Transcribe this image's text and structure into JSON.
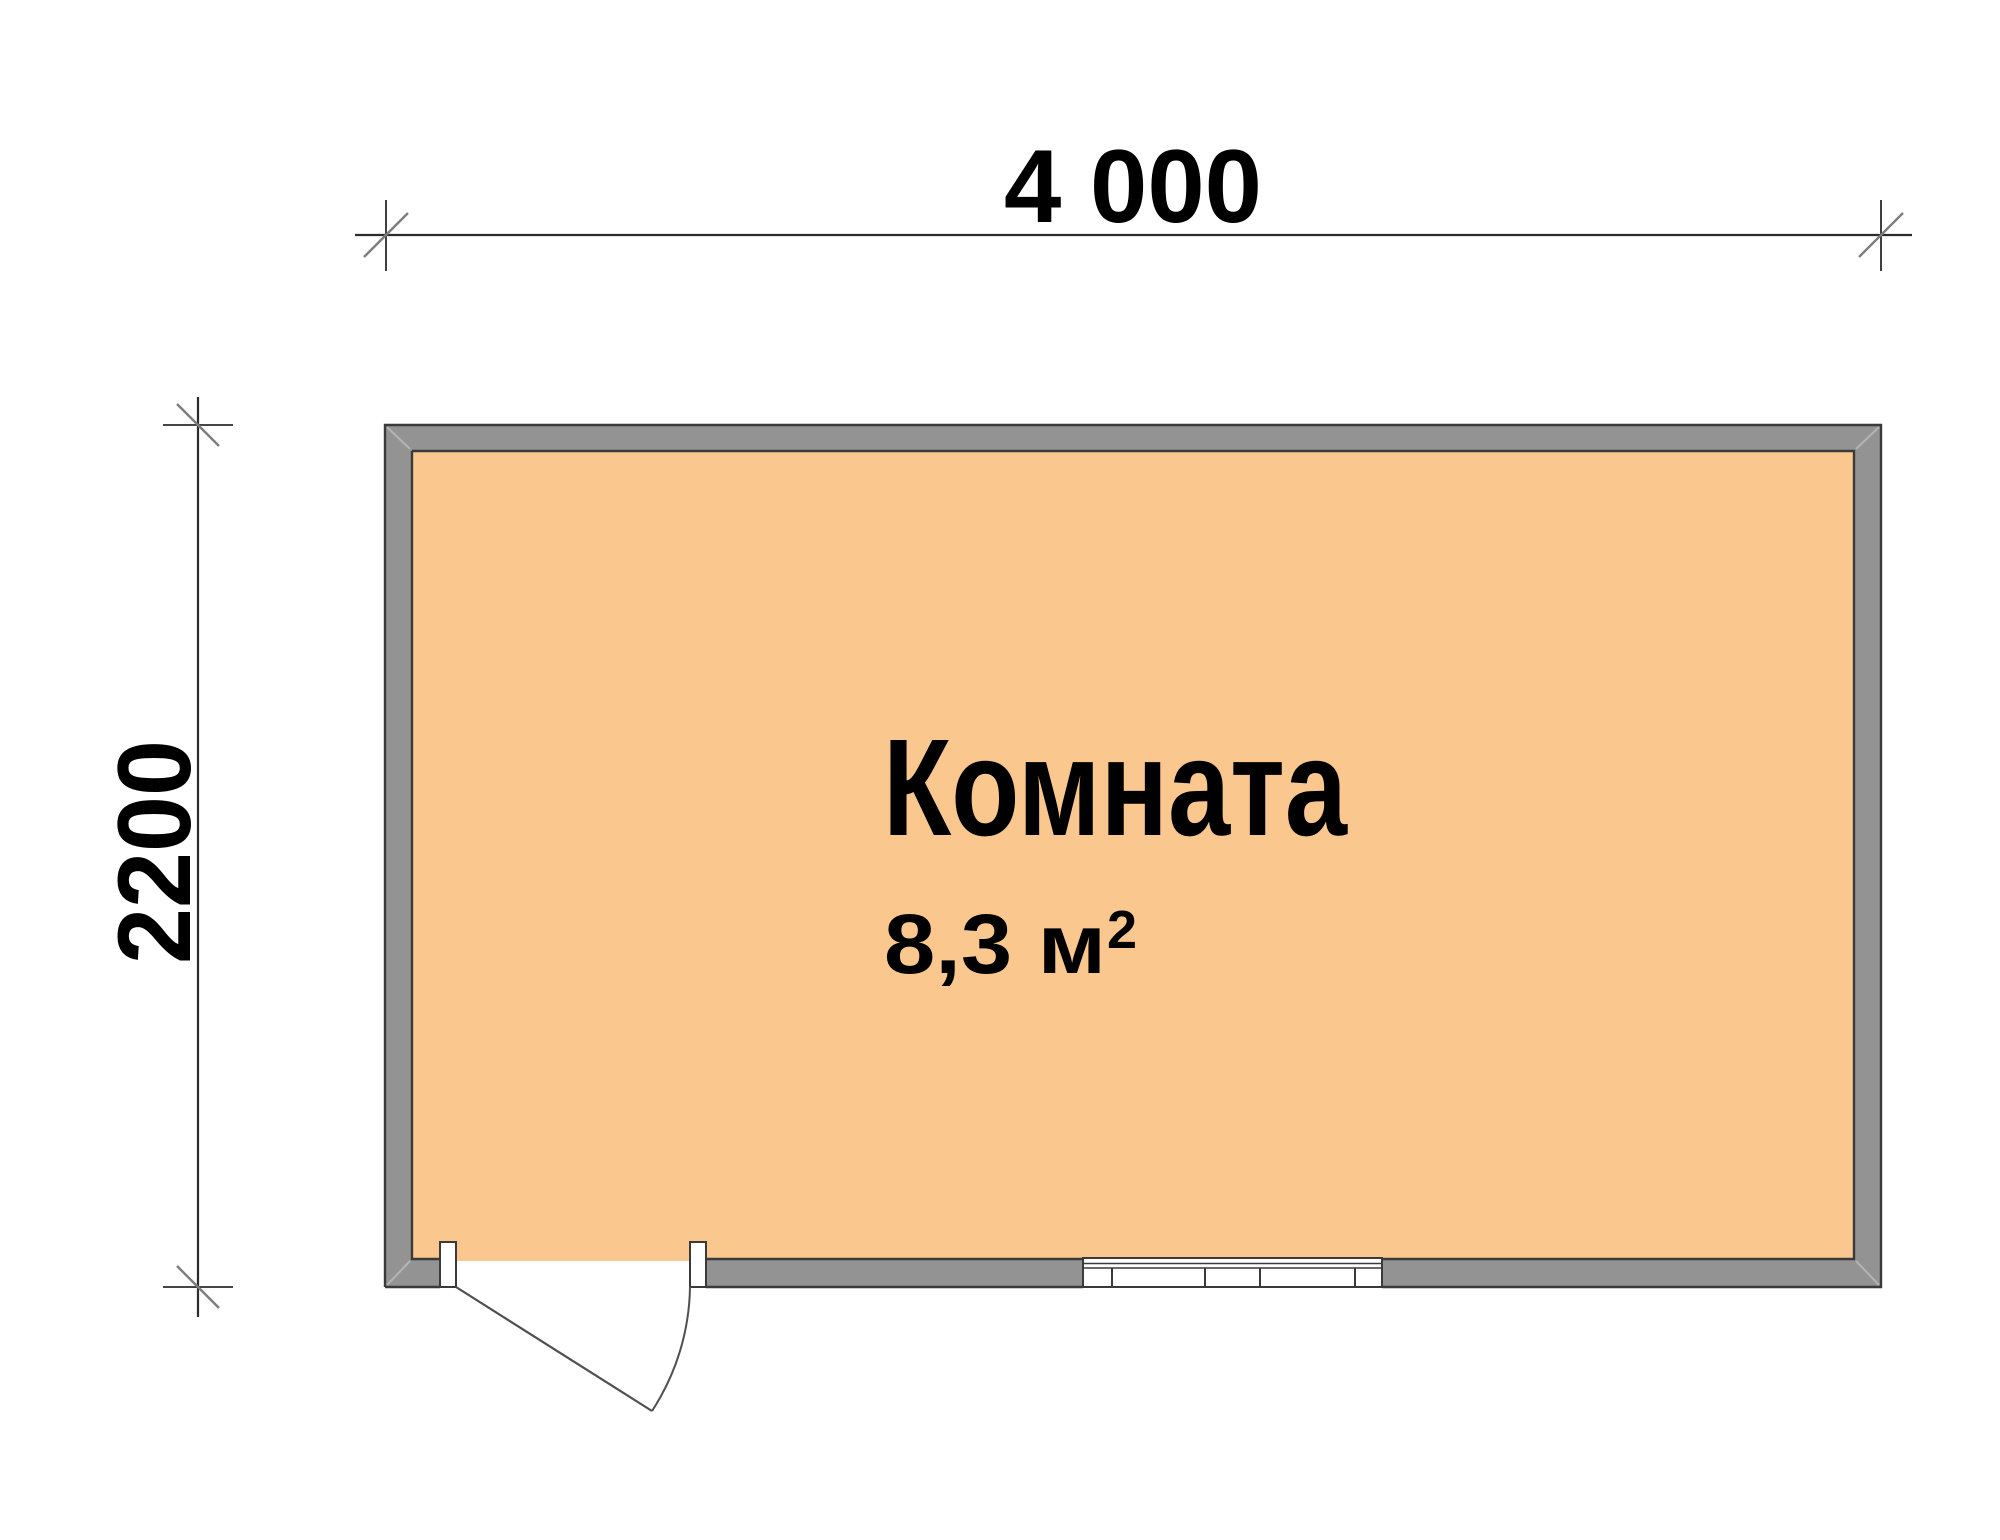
{
  "plan": {
    "room": {
      "name": "Комната",
      "area_value": "8,3 м",
      "area_superscript": "2"
    },
    "dimensions": {
      "width_label": "4 000",
      "height_label": "2200"
    },
    "colors": {
      "floor_fill": "#fac88f",
      "wall_fill": "#939393",
      "wall_outline": "#3a3a3a",
      "miter_line": "#b4b4b4",
      "opening_fill": "#ffffff",
      "door_line": "#4f4f4f",
      "dimension_line": "#2b2b2b",
      "tick_slash": "#7d7d7d",
      "label_color": "#000000"
    }
  }
}
